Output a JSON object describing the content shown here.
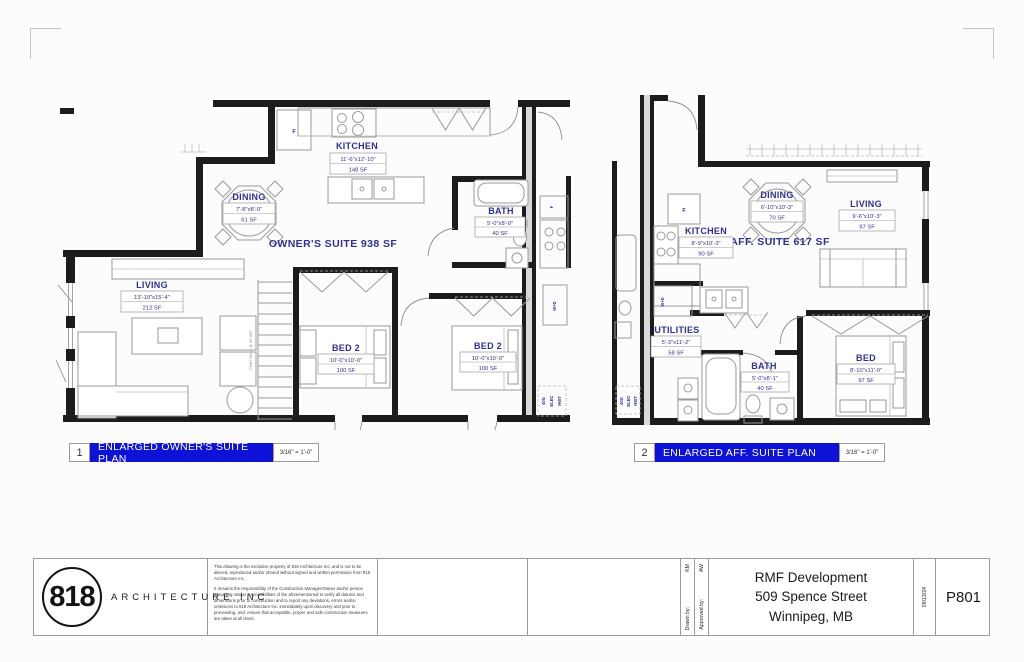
{
  "colors": {
    "accent_blue": "#0d12d6",
    "label_navy": "#2e3192",
    "wall_black": "#1c1c1c"
  },
  "plan1": {
    "number": "1",
    "title": "ENLARGED OWNER'S SUITE PLAN",
    "scale": "3/16\" = 1'-0\"",
    "suite_label": "OWNER'S SUITE 938 SF",
    "rooms": {
      "kitchen": {
        "name": "KITCHEN",
        "dims": "11'-6\"x12'-10\"",
        "area": "148 SF"
      },
      "dining": {
        "name": "DINING",
        "dims": "7'-8\"x8'-0\"",
        "area": "61 SF"
      },
      "living": {
        "name": "LIVING",
        "dims": "13'-10\"x15'-4\"",
        "area": "212 SF"
      },
      "bath": {
        "name": "BATH",
        "dims": "5'-0\"x8'-0\"",
        "area": "40 SF"
      },
      "bed2a": {
        "name": "BED 2",
        "dims": "10'-0\"x10'-0\"",
        "area": "100 SF"
      },
      "bed2b": {
        "name": "BED 2",
        "dims": "10'-0\"x10'-0\"",
        "area": "100 SF"
      }
    },
    "annotations": {
      "fridge": "F",
      "washer_dryer": "W+D",
      "tank": "40G",
      "elec": "ELEC",
      "hwt": "HWT",
      "pony_wall": "PONY WALL @ 36\" AFF"
    }
  },
  "plan2": {
    "number": "2",
    "title": "ENLARGED AFF. SUITE PLAN",
    "scale": "3/16\" = 1'-0\"",
    "suite_label": "AFF. SUITE 617 SF",
    "rooms": {
      "dining": {
        "name": "DINING",
        "dims": "6'-10\"x10'-3\"",
        "area": "70 SF"
      },
      "living": {
        "name": "LIVING",
        "dims": "9'-6\"x10'-3\"",
        "area": "97 SF"
      },
      "kitchen": {
        "name": "KITCHEN",
        "dims": "8'-9\"x10'-3\"",
        "area": "90 SF"
      },
      "utilities": {
        "name": "UTILITIES",
        "dims": "5'-3\"x11'-2\"",
        "area": "58 SF"
      },
      "bath": {
        "name": "BATH",
        "dims": "5'-0\"x8'-1\"",
        "area": "40 SF"
      },
      "bed": {
        "name": "BED",
        "dims": "8'-10\"x11'-0\"",
        "area": "97 SF"
      }
    },
    "annotations": {
      "fridge": "F",
      "washer_dryer": "W+D",
      "tank": "40G",
      "elec": "ELEC",
      "hwt": "HWT"
    }
  },
  "titleblock": {
    "logo_number": "818",
    "logo_name": "ARCHITECTURE INC",
    "disclaimer_p1": "This drawing is the exclusive property of 818 Architecture Inc. and is not to be altered, reproduced and/or shared without signed and written permission from 818 Architecture Inc.",
    "disclaimer_p2": "It remains the responsibility of the Construction Manager/Owner and/or person assuming similar responsibilities of the aforementioned to verify all datums and dimensions prior to construction and to report any deviations, errors and/or omissions to 818 Architecture Inc. immediately upon discovery and prior to proceeding, and, ensure that acceptable, proper and safe construction measures are taken at all times.",
    "drawn_by_label": "Drawn by:",
    "drawn_by_value": "KM",
    "approved_by_label": "Approved by:",
    "approved_by_value": "AW",
    "project_line1": "RMF Development",
    "project_line2": "509 Spence Street",
    "project_line3": "Winnipeg, MB",
    "date": "09/13/24",
    "sheet_number": "P801"
  }
}
